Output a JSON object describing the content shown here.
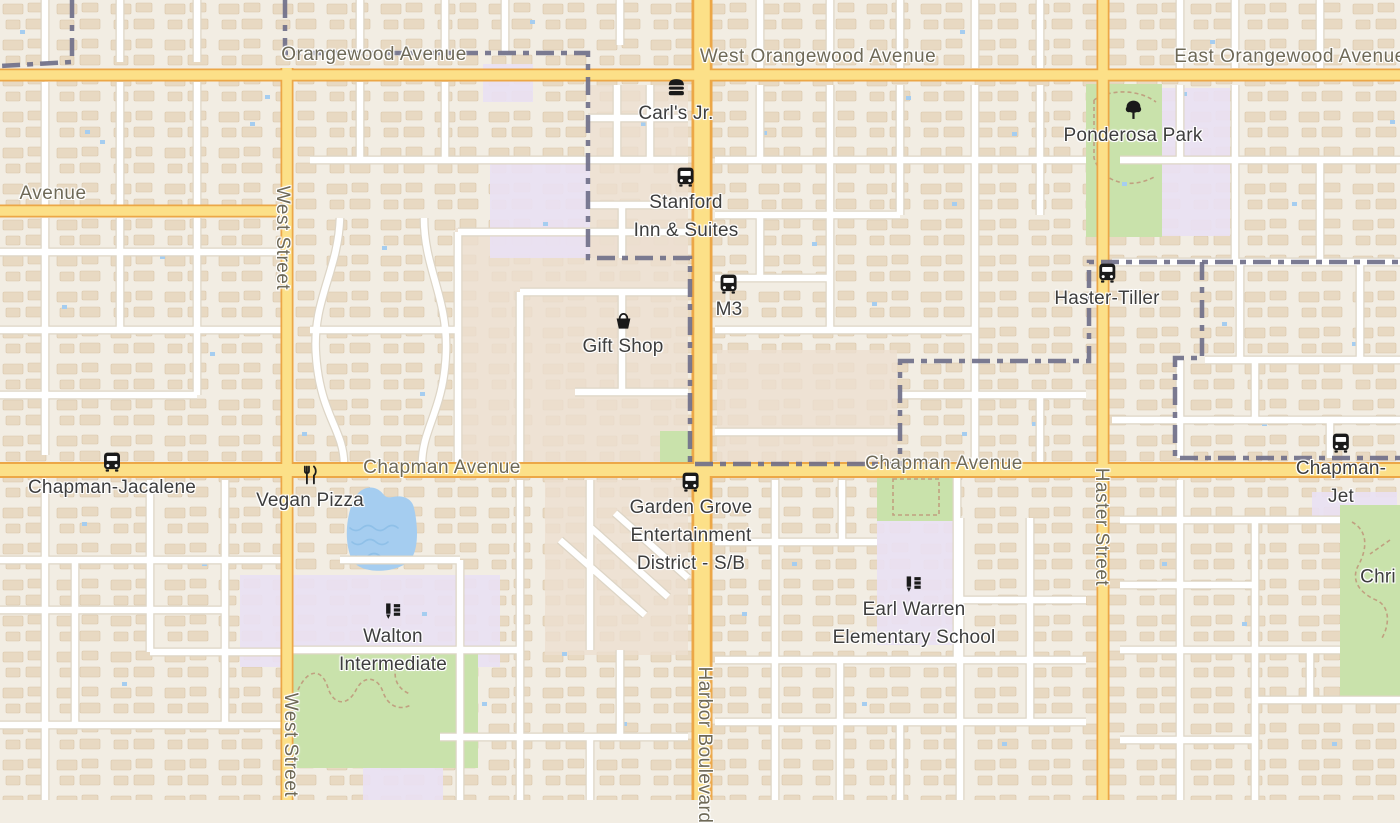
{
  "map_type": "street-map",
  "streets": [
    {
      "label": "Orangewood Avenue"
    },
    {
      "label": "West Orangewood Avenue"
    },
    {
      "label": "East Orangewood Avenue"
    },
    {
      "label": "Avenue"
    },
    {
      "label": "Chapman Avenue"
    },
    {
      "label": "Chapman Avenue"
    },
    {
      "label": "West Street"
    },
    {
      "label": "West Street"
    },
    {
      "label": "Harbor Boulevard"
    },
    {
      "label": "Haster Street"
    }
  ],
  "pois": [
    {
      "name": "Carl's Jr.",
      "icon": "fast-food-icon"
    },
    {
      "name": "Stanford\nInn & Suites",
      "icon": "bus-icon"
    },
    {
      "name": "M3",
      "icon": "bus-icon"
    },
    {
      "name": "Gift Shop",
      "icon": "shop-icon"
    },
    {
      "name": "Ponderosa Park",
      "icon": "tree-icon"
    },
    {
      "name": "Haster-Tiller",
      "icon": "bus-icon"
    },
    {
      "name": "Chapman-Jacalene",
      "icon": "bus-icon"
    },
    {
      "name": "Vegan Pizza",
      "icon": "restaurant-icon"
    },
    {
      "name": "Garden Grove\nEntertainment\nDistrict - S/B",
      "icon": "bus-icon"
    },
    {
      "name": "Earl Warren\nElementary School",
      "icon": "school-icon"
    },
    {
      "name": "Walton\nIntermediate",
      "icon": "school-icon"
    },
    {
      "name": "Chapman-Jet",
      "icon": "bus-icon"
    },
    {
      "name": "Chri",
      "icon": null
    }
  ],
  "colors": {
    "land": "#f2ede3",
    "building": "#e8d9c2",
    "road_major_fill": "#fce088",
    "road_major_casing": "#eca747",
    "road_minor_fill": "#ffffff",
    "road_minor_casing": "#ddd5c6",
    "boundary": "#70708a",
    "water": "#a5cdf0",
    "park": "#c9e2ab",
    "school_area": "#e9e1f3",
    "poi_label": "#3d3d3d",
    "street_label": "#6e6957"
  }
}
